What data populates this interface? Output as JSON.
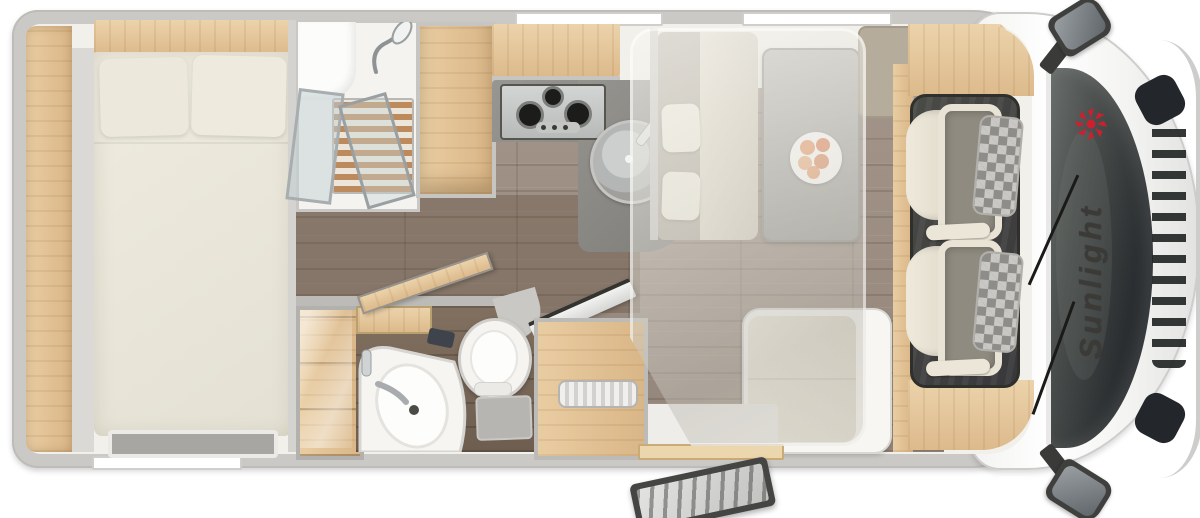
{
  "brand": {
    "logo_text": "Sunlight",
    "logo_color": "#cf1f2e",
    "text_color": "#3b3a36"
  },
  "palette": {
    "body_wall": "#cac9c6",
    "cab_body": "#ffffff",
    "interior": "#f2f0ea",
    "wood_light": "#ecd3ab",
    "wood_mid": "#d9b687",
    "floor": "#9c8d80",
    "floor_dark": "#77675a",
    "counter": "#8e8d88",
    "stainless": "#cbcdcc",
    "mattress": "#edeadf",
    "cushion": "#e7e2d4",
    "taupe": "#b6ac9b",
    "cab_mat": "#454441",
    "glass_tint": "#c3d2d6",
    "windshield": "#24282b",
    "accent_red": "#cf1f2e"
  },
  "windows": {
    "top_count": 2,
    "bottom_count": 1
  },
  "fixtures": [
    "double-bed",
    "pillow",
    "headboard-shelf",
    "side-shelf",
    "foot-vent",
    "shower-cabin",
    "shower-glass-door",
    "shower-slat-floor",
    "shower-head",
    "wardrobe",
    "overhead-locker",
    "gas-hob",
    "hob-burner",
    "kitchen-sink",
    "faucet",
    "dinette-bench",
    "headrest",
    "dinette-table",
    "fruit-plate",
    "side-bench",
    "sideboard",
    "l-bench",
    "drop-down-bed-overlay",
    "glass-cabinet",
    "washbasin",
    "vanity",
    "toilet",
    "bathroom-door",
    "shower-partition-door",
    "step-stool",
    "storage-unit",
    "tambour-door",
    "entry-step",
    "entry-door",
    "cab-mat",
    "cab-seat",
    "dashboard-shelf",
    "windshield",
    "wiper",
    "front-grille",
    "headlight",
    "wing-mirror",
    "window-top-1",
    "window-top-2",
    "window-bottom"
  ]
}
